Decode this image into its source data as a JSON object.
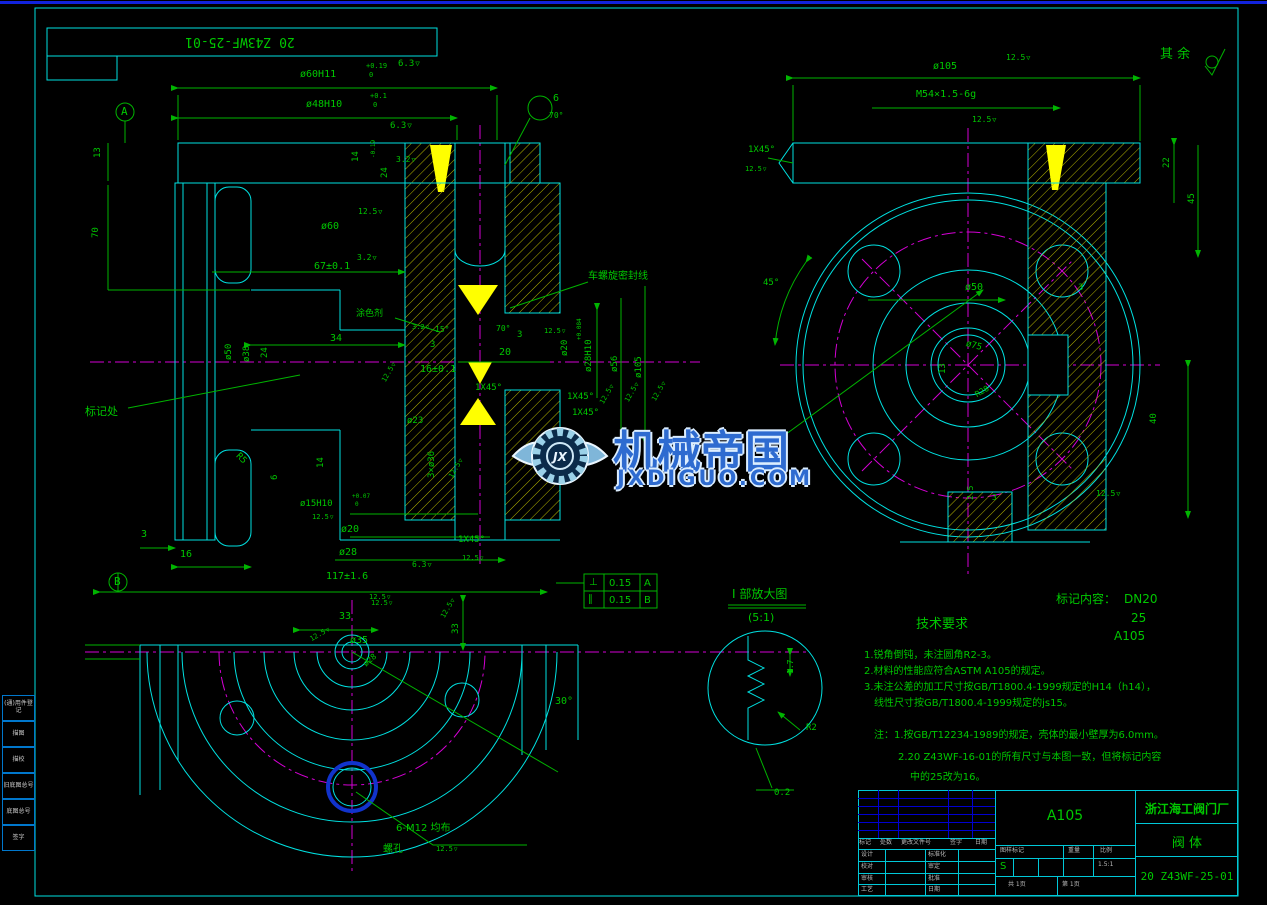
{
  "page": {
    "title_top": "20 Z43WF-25-01",
    "surface_note": "其 余"
  },
  "watermark": {
    "title": "机械帝国",
    "site": "JXDIGUO.COM"
  },
  "marking": {
    "label": "标记内容：",
    "v1": "DN20",
    "v2": "25",
    "v3": "A105"
  },
  "tech": {
    "heading": "技术要求",
    "l1": "1.锐角倒钝，未注圆角R2-3。",
    "l2": "2.材料的性能应符合ASTM A105的规定。",
    "l3": "3.未注公差的加工尺寸按GB/T1800.4-1999规定的H14（h14），",
    "l4": "线性尺寸按GB/T1800.4-1999规定的js15。"
  },
  "notes": {
    "l1": "注：1.按GB/T12234-1989的规定，壳体的最小壁厚为6.0mm。",
    "l2": "2.20 Z43WF-16-01的所有尺寸与本图一致，但将标记内容",
    "l3": "中的25改为16。"
  },
  "detail_view": {
    "title": "Ⅰ 部放大图",
    "scale": "(5:1)"
  },
  "gdt": {
    "r1s": "⊥",
    "r1v": "0.15",
    "r1d": "A",
    "r2s": "∥",
    "r2v": "0.15",
    "r2d": "B"
  },
  "title_block": {
    "material": "A105",
    "company": "浙江海工阀门厂",
    "part_name": "阀    体",
    "drawing_no": "20 Z43WF-25-01",
    "rev_header": [
      "标记",
      "处数",
      "更改文件号",
      "签字",
      "日期"
    ],
    "sign_rows": [
      [
        "设计",
        "标准化"
      ],
      [
        "校对",
        "审定"
      ],
      [
        "审核",
        "批准"
      ],
      [
        "工艺",
        "日期"
      ]
    ],
    "stamp_header": [
      "图样标记",
      "重量",
      "比例"
    ],
    "stamp_mark": "S",
    "scale": "1.5:1",
    "sheet_total": "共 1页",
    "sheet_no": "第 1页"
  },
  "margin": {
    "items": [
      "(通)用件登记",
      "描图",
      "描校",
      "旧底图总号",
      "底图总号",
      "签字"
    ]
  },
  "labels": [
    {
      "t": "ø60H11",
      "x": 300,
      "y": 70
    },
    {
      "t": "+0.19",
      "x": 366,
      "y": 63,
      "s": 7
    },
    {
      "t": "0",
      "x": 369,
      "y": 72,
      "s": 7
    },
    {
      "t": "6.3",
      "x": 398,
      "y": 60,
      "f": 1,
      "s": 9
    },
    {
      "t": "ø48H10",
      "x": 306,
      "y": 100
    },
    {
      "t": "+0.1",
      "x": 370,
      "y": 93,
      "s": 7
    },
    {
      "t": "0",
      "x": 373,
      "y": 102,
      "s": 7
    },
    {
      "t": "6.3",
      "x": 390,
      "y": 122,
      "f": 1,
      "s": 9
    },
    {
      "t": "6",
      "x": 553,
      "y": 94
    },
    {
      "t": "70°",
      "x": 549,
      "y": 112,
      "s": 8
    },
    {
      "t": "A",
      "x": 121,
      "y": 106,
      "s": 11
    },
    {
      "t": "B",
      "x": 114,
      "y": 576,
      "s": 11
    },
    {
      "t": "13",
      "x": 94,
      "y": 158,
      "r": -90,
      "s": 9
    },
    {
      "t": "70",
      "x": 92,
      "y": 238,
      "r": -90,
      "s": 9
    },
    {
      "t": "14",
      "x": 352,
      "y": 162,
      "r": -90,
      "s": 9
    },
    {
      "t": "24",
      "x": 381,
      "y": 178,
      "r": -90,
      "s": 9
    },
    {
      "t": "-0.19",
      "x": 371,
      "y": 158,
      "r": -90,
      "s": 6
    },
    {
      "t": "3.2",
      "x": 396,
      "y": 156,
      "f": 1,
      "s": 8
    },
    {
      "t": "ø60",
      "x": 321,
      "y": 222
    },
    {
      "t": "12.5",
      "x": 358,
      "y": 208,
      "f": 1,
      "s": 8
    },
    {
      "t": "67±0.1",
      "x": 314,
      "y": 262
    },
    {
      "t": "3.2",
      "x": 357,
      "y": 254,
      "f": 1,
      "s": 8
    },
    {
      "t": "车螺旋密封线",
      "x": 588,
      "y": 272,
      "cls": "cn",
      "s": 10
    },
    {
      "t": "涂色剂",
      "x": 356,
      "y": 310,
      "cls": "cn",
      "s": 9
    },
    {
      "t": "标记处",
      "x": 85,
      "y": 406,
      "cls": "cn",
      "s": 11
    },
    {
      "t": "ø50",
      "x": 225,
      "y": 360,
      "r": -90,
      "s": 9
    },
    {
      "t": "ø38",
      "x": 243,
      "y": 362,
      "r": -90,
      "s": 9
    },
    {
      "t": "24",
      "x": 261,
      "y": 358,
      "r": -90,
      "s": 9
    },
    {
      "t": "34",
      "x": 330,
      "y": 334
    },
    {
      "t": "3.2",
      "x": 412,
      "y": 324,
      "f": 1,
      "s": 7
    },
    {
      "t": "15°",
      "x": 435,
      "y": 326,
      "s": 8
    },
    {
      "t": "3",
      "x": 430,
      "y": 341,
      "s": 9
    },
    {
      "t": "70°",
      "x": 496,
      "y": 325,
      "s": 8
    },
    {
      "t": "3",
      "x": 517,
      "y": 331,
      "s": 9
    },
    {
      "t": "20",
      "x": 499,
      "y": 348
    },
    {
      "t": "16±0.1",
      "x": 420,
      "y": 365
    },
    {
      "t": "1X45°",
      "x": 475,
      "y": 384,
      "s": 9
    },
    {
      "t": "12.5",
      "x": 381,
      "y": 380,
      "r": -60,
      "s": 7,
      "f": 1
    },
    {
      "t": "ø20",
      "x": 561,
      "y": 356,
      "r": -90,
      "s": 9
    },
    {
      "t": "12.5",
      "x": 544,
      "y": 328,
      "f": 1,
      "s": 7
    },
    {
      "t": "ø28H10",
      "x": 585,
      "y": 372,
      "r": -90,
      "s": 9
    },
    {
      "t": "+0.084",
      "x": 577,
      "y": 340,
      "r": -90,
      "s": 6
    },
    {
      "t": "ø56",
      "x": 611,
      "y": 372,
      "r": -90,
      "s": 9
    },
    {
      "t": "ø105",
      "x": 635,
      "y": 378,
      "r": -90,
      "s": 9
    },
    {
      "t": "1X45°",
      "x": 567,
      "y": 393,
      "s": 9
    },
    {
      "t": "1X45°",
      "x": 572,
      "y": 409,
      "s": 9
    },
    {
      "t": "12.5",
      "x": 599,
      "y": 402,
      "r": -60,
      "s": 7,
      "f": 1
    },
    {
      "t": "12.5",
      "x": 624,
      "y": 400,
      "r": -60,
      "s": 7,
      "f": 1
    },
    {
      "t": "12.5",
      "x": 651,
      "y": 399,
      "r": -60,
      "s": 7,
      "f": 1
    },
    {
      "t": "ø23",
      "x": 407,
      "y": 417,
      "s": 9
    },
    {
      "t": "3×ø36",
      "x": 428,
      "y": 478,
      "r": -90,
      "s": 9
    },
    {
      "t": "12.5",
      "x": 448,
      "y": 476,
      "r": -60,
      "s": 7,
      "f": 1
    },
    {
      "t": "R5",
      "x": 240,
      "y": 452,
      "r": 45,
      "s": 9
    },
    {
      "t": "14",
      "x": 317,
      "y": 468,
      "r": -90,
      "s": 9
    },
    {
      "t": "6",
      "x": 271,
      "y": 480,
      "r": -90,
      "s": 9
    },
    {
      "t": "ø15H10",
      "x": 300,
      "y": 500,
      "s": 9
    },
    {
      "t": "+0.07",
      "x": 352,
      "y": 494,
      "s": 6
    },
    {
      "t": "0",
      "x": 355,
      "y": 502,
      "s": 6
    },
    {
      "t": "12.5",
      "x": 312,
      "y": 514,
      "f": 1,
      "s": 7
    },
    {
      "t": "ø20",
      "x": 341,
      "y": 525
    },
    {
      "t": "ø28",
      "x": 339,
      "y": 548
    },
    {
      "t": "3",
      "x": 141,
      "y": 530
    },
    {
      "t": "16",
      "x": 180,
      "y": 550
    },
    {
      "t": "117±1.6",
      "x": 326,
      "y": 572
    },
    {
      "t": "6.3",
      "x": 412,
      "y": 561,
      "f": 1,
      "s": 8
    },
    {
      "t": "12.5",
      "x": 369,
      "y": 594,
      "f": 1,
      "s": 7
    },
    {
      "t": "1X45°",
      "x": 458,
      "y": 536,
      "s": 9
    },
    {
      "t": "12.5",
      "x": 462,
      "y": 555,
      "f": 1,
      "s": 7
    },
    {
      "t": "33",
      "x": 339,
      "y": 612
    },
    {
      "t": "12.5",
      "x": 371,
      "y": 600,
      "f": 1,
      "s": 7
    },
    {
      "t": "12.5",
      "x": 309,
      "y": 637,
      "r": -30,
      "s": 7,
      "f": 1
    },
    {
      "t": "ø35",
      "x": 350,
      "y": 636
    },
    {
      "t": "ø28",
      "x": 362,
      "y": 662,
      "r": -40,
      "s": 8
    },
    {
      "t": "33",
      "x": 452,
      "y": 634,
      "r": -90,
      "s": 9
    },
    {
      "t": "12.5",
      "x": 440,
      "y": 616,
      "r": -60,
      "s": 7,
      "f": 1
    },
    {
      "t": "30°",
      "x": 555,
      "y": 697
    },
    {
      "t": "6-M12 均布",
      "x": 396,
      "y": 824,
      "cls": "cn",
      "s": 10
    },
    {
      "t": "螺孔",
      "x": 383,
      "y": 845,
      "cls": "cn",
      "s": 10
    },
    {
      "t": "12.5",
      "x": 436,
      "y": 846,
      "f": 1,
      "s": 7
    },
    {
      "t": "ø105",
      "x": 933,
      "y": 62
    },
    {
      "t": "12.5",
      "x": 1006,
      "y": 54,
      "f": 1,
      "s": 8
    },
    {
      "t": "M54×1.5-6g",
      "x": 916,
      "y": 90
    },
    {
      "t": "12.5",
      "x": 972,
      "y": 116,
      "f": 1,
      "s": 8
    },
    {
      "t": "1X45°",
      "x": 748,
      "y": 146,
      "s": 9
    },
    {
      "t": "12.5",
      "x": 745,
      "y": 166,
      "f": 1,
      "s": 7
    },
    {
      "t": "22",
      "x": 1163,
      "y": 168,
      "r": -90,
      "s": 9
    },
    {
      "t": "45",
      "x": 1188,
      "y": 204,
      "r": -90,
      "s": 9
    },
    {
      "t": "45°",
      "x": 763,
      "y": 279,
      "s": 9
    },
    {
      "t": "ø50",
      "x": 965,
      "y": 283
    },
    {
      "t": "3",
      "x": 1078,
      "y": 284,
      "s": 9
    },
    {
      "t": "ø75",
      "x": 967,
      "y": 340,
      "r": 15,
      "s": 9
    },
    {
      "t": "13",
      "x": 939,
      "y": 374,
      "r": -90,
      "s": 9
    },
    {
      "t": "R28",
      "x": 974,
      "y": 392,
      "r": -30,
      "s": 8
    },
    {
      "t": "40",
      "x": 1150,
      "y": 424,
      "r": -90,
      "s": 9
    },
    {
      "t": "2.5",
      "x": 967,
      "y": 500,
      "r": -90,
      "s": 8
    },
    {
      "t": "3",
      "x": 992,
      "y": 494,
      "s": 8
    },
    {
      "t": "12.5",
      "x": 1096,
      "y": 490,
      "f": 1,
      "s": 8
    },
    {
      "t": "1.7",
      "x": 787,
      "y": 674,
      "r": -90,
      "s": 8
    },
    {
      "t": "R2",
      "x": 806,
      "y": 724,
      "s": 9
    },
    {
      "t": "0.2",
      "x": 774,
      "y": 789,
      "s": 9
    }
  ]
}
